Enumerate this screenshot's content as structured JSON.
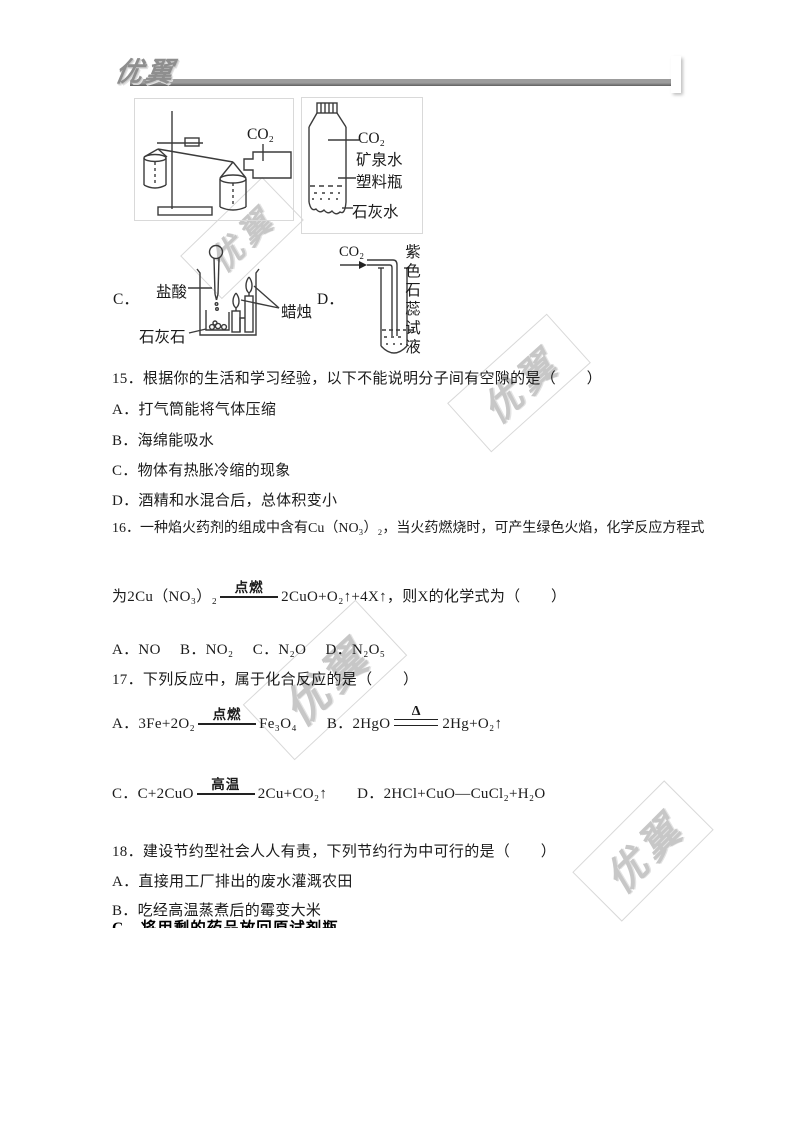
{
  "header": {
    "logo": "优翼"
  },
  "watermark": {
    "text": "优翼"
  },
  "colors": {
    "text": "#1b1b1b",
    "rule_gradient_start": "#9c9c9c",
    "rule_gradient_end": "#5f5f5f",
    "watermark": "#c7c7c7"
  },
  "diagrams": {
    "a": {
      "co2_label": "CO₂"
    },
    "b": {
      "co2_label": "CO₂",
      "bottle_line1": "矿泉水",
      "bottle_line2": "塑料瓶",
      "limewater": "石灰水"
    },
    "c": {
      "option_label": "C．",
      "acid": "盐酸",
      "candles": "蜡烛",
      "limestone": "石灰石"
    },
    "d": {
      "option_label": "D．",
      "co2_label": "CO₂",
      "litmus_vertical": "紫色石蕊试液"
    }
  },
  "q15": {
    "stem": "15．根据你的生活和学习经验，以下不能说明分子间有空隙的是（　　）",
    "options": [
      "A．打气筒能将气体压缩",
      "B．海绵能吸水",
      "C．物体有热胀冷缩的现象",
      "D．酒精和水混合后，总体积变小"
    ]
  },
  "q16": {
    "stem": "16．一种焰火药剂的组成中含有Cu（NO₃）₂，当火药燃烧时，可产生绿色火焰，化学反应方程式",
    "eq_left": "为2Cu（NO₃）₂",
    "eq_condition": "点燃",
    "eq_right": "2CuO+O₂↑+4X↑，则X的化学式为（　　）",
    "options_line": "A．NO　 B．NO₂　 C．N₂O　 D．N₂O₅"
  },
  "q17": {
    "stem": "17．下列反应中，属于化合反应的是（　　）",
    "a_left": "A．3Fe+2O₂",
    "a_condition": "点燃",
    "a_right": "Fe₃O₄",
    "b_left": "B．2HgO",
    "b_condition": "Δ",
    "b_right": "2Hg+O₂↑",
    "c_left": "C．C+2CuO",
    "c_condition": "高温",
    "c_right": "2Cu+CO₂↑",
    "d_text": "D．2HCl+CuO—CuCl₂+H₂O"
  },
  "q18": {
    "stem": "18．建设节约型社会人人有责，下列节约行为中可行的是（　　）",
    "options": [
      "A．直接用工厂排出的废水灌溉农田",
      "B．吃经高温蒸煮后的霉变大米"
    ],
    "clipped_option": "C．将用剩的药品放回原试剂瓶"
  }
}
